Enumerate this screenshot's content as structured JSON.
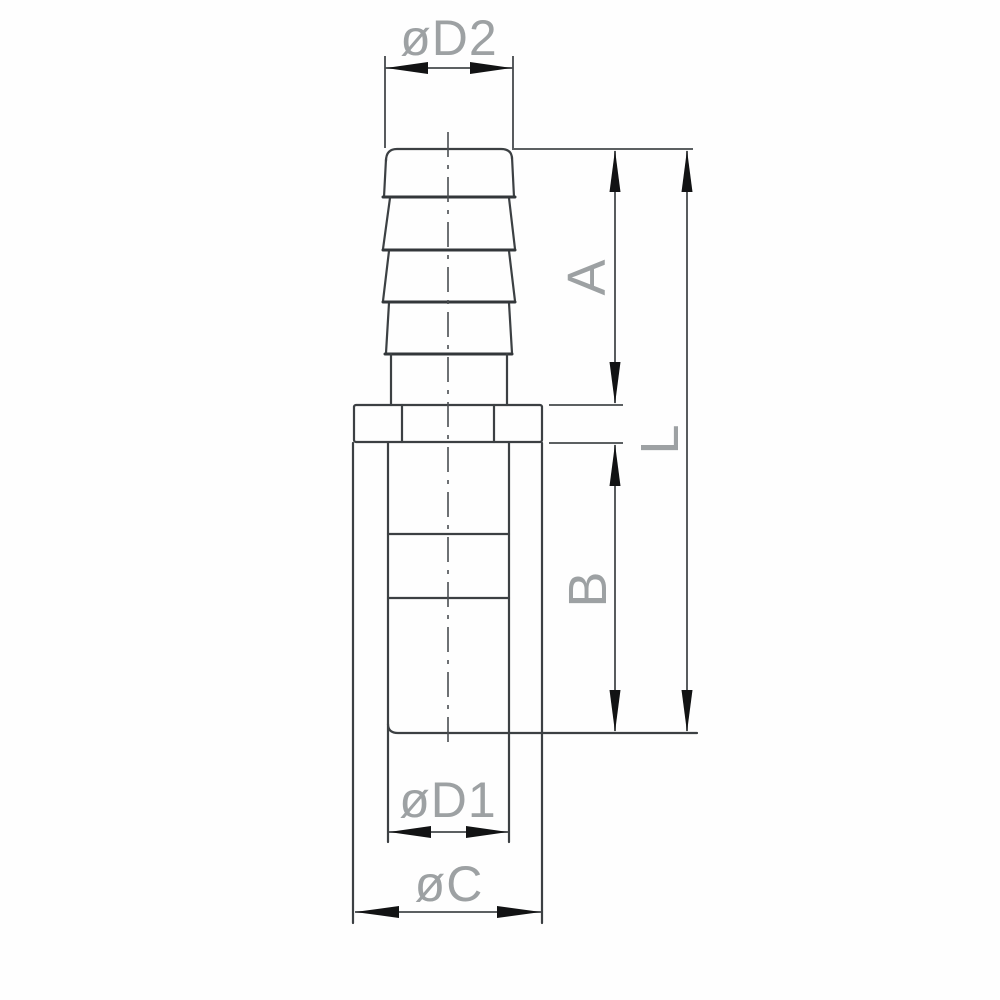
{
  "labels": {
    "d2": "øD2",
    "a": "A",
    "l": "L",
    "b": "B",
    "d1": "øD1",
    "c": "øC"
  },
  "colors": {
    "background": "#fefefe",
    "line": "#3c4043",
    "ridge": "#33373a",
    "dimline": "#45494c",
    "centerline": "#4a4e51",
    "arrow": "#121314",
    "label_text": "#9da1a3"
  }
}
